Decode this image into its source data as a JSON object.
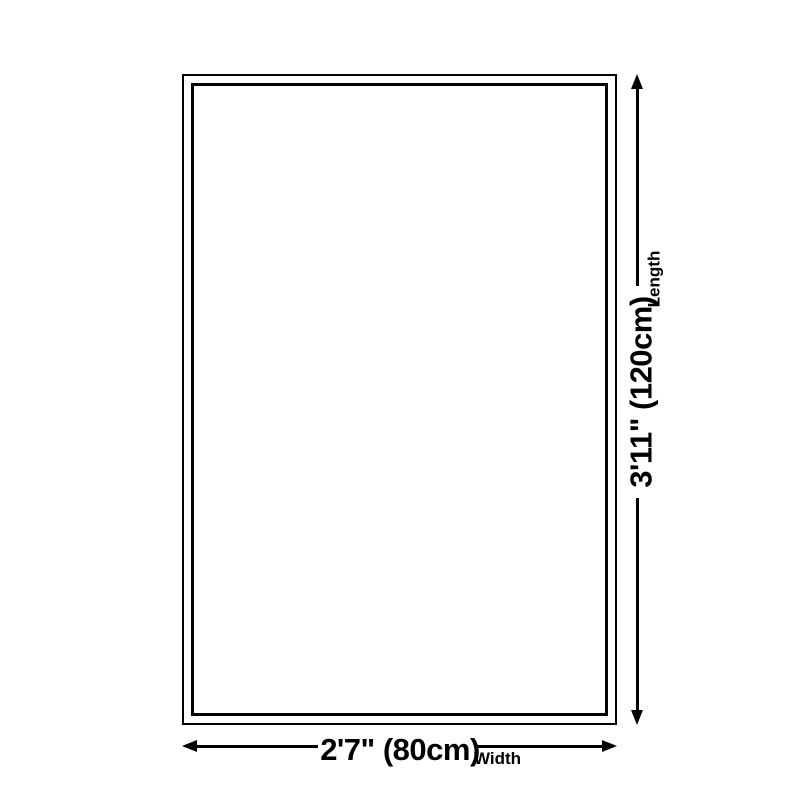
{
  "page": {
    "background_color": "#ffffff",
    "line_color": "#000000"
  },
  "diagram": {
    "length": {
      "value": "3'11\" (120cm)",
      "caption": "Length"
    },
    "width": {
      "value": "2'7\" (80cm)",
      "caption": "Width"
    }
  }
}
